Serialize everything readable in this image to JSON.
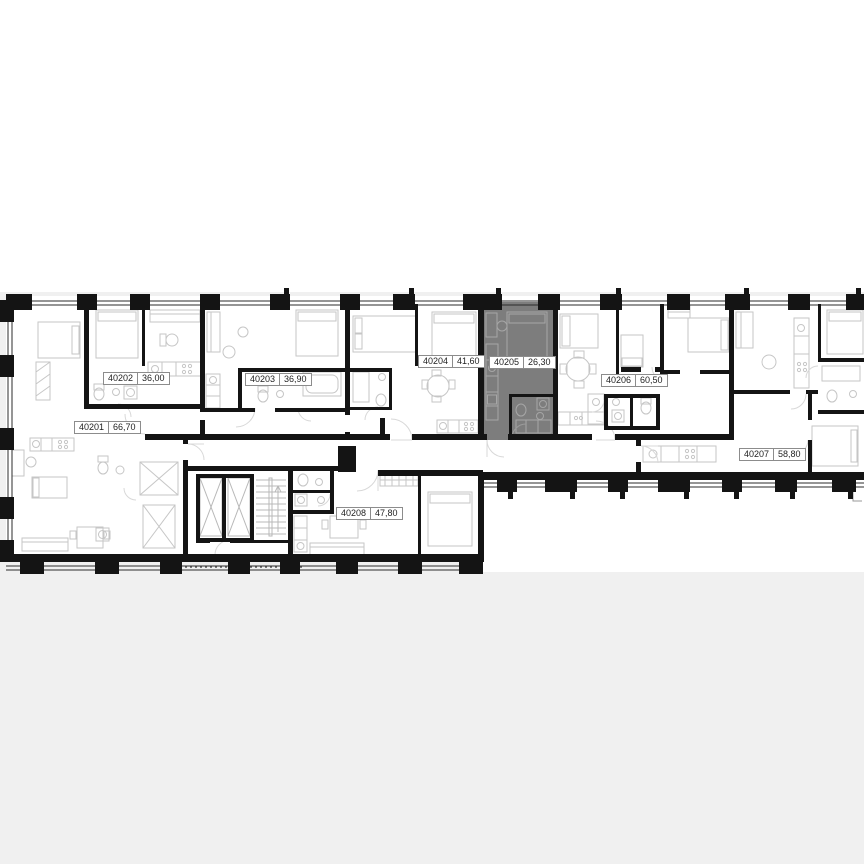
{
  "viewer": {
    "background": "#ffffff",
    "canvas_band_color": "#f0f0f0",
    "canvas_band_top": 292
  },
  "plan": {
    "wall_color": "#141414",
    "highlight_color": "#7d7d7d",
    "units": [
      {
        "id": "40201",
        "area": "66,70",
        "label_x": 74,
        "label_y": 421,
        "highlighted": false
      },
      {
        "id": "40202",
        "area": "36,00",
        "label_x": 103,
        "label_y": 372,
        "highlighted": false
      },
      {
        "id": "40203",
        "area": "36,90",
        "label_x": 245,
        "label_y": 373,
        "highlighted": false
      },
      {
        "id": "40204",
        "area": "41,60",
        "label_x": 418,
        "label_y": 355,
        "highlighted": false
      },
      {
        "id": "40205",
        "area": "26,30",
        "label_x": 489,
        "label_y": 356,
        "highlighted": true
      },
      {
        "id": "40206",
        "area": "60,50",
        "label_x": 601,
        "label_y": 374,
        "highlighted": false
      },
      {
        "id": "40207",
        "area": "58,80",
        "label_x": 739,
        "label_y": 448,
        "highlighted": false
      },
      {
        "id": "40208",
        "area": "47,80",
        "label_x": 336,
        "label_y": 507,
        "highlighted": false
      }
    ]
  }
}
